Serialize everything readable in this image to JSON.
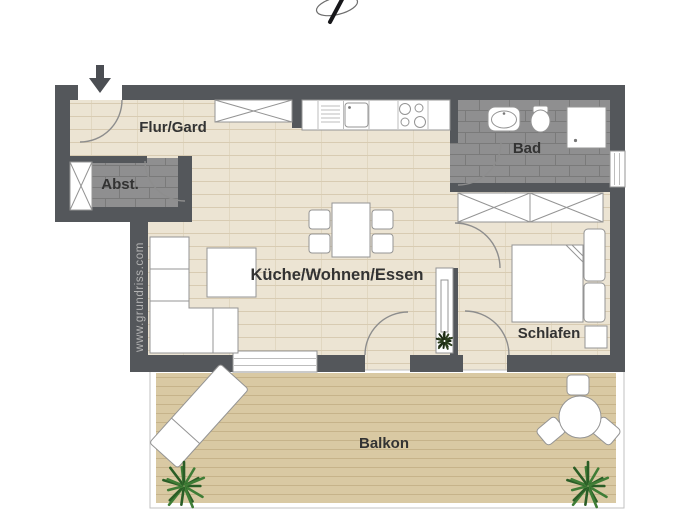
{
  "rooms": {
    "flur": "Flur/Gard",
    "abst": "Abst.",
    "bad": "Bad",
    "wohnen": "Küche/Wohnen/Essen",
    "schlafen": "Schlafen",
    "balkon": "Balkon"
  },
  "watermark": "www.grundriss.com",
  "icons": {
    "entry_arrow": "arrow-down",
    "logo_mark": "pen-swash-logo",
    "plants": "potted-plant-starburst"
  },
  "colors": {
    "wall": "#54575b",
    "wood_floor": "#ece4d3",
    "tile_floor": "#8f8f90",
    "deck_floor": "#d9c9a3",
    "furniture_outline": "#949494",
    "label_text": "#333333",
    "watermark_gray": "#b3b3b3",
    "plant_green": "#3f7d36",
    "plant_green_dark": "#2a5d26",
    "entry_arrow": "#4b4e53"
  }
}
